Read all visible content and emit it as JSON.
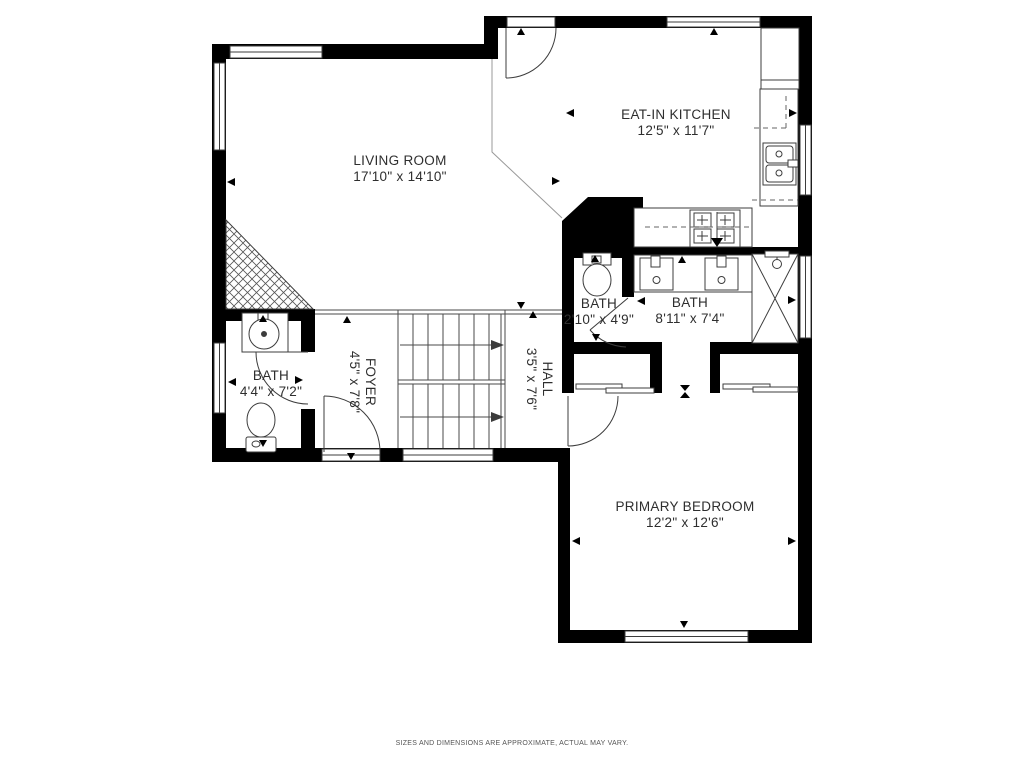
{
  "rooms": {
    "living_room": {
      "name": "LIVING ROOM",
      "dims": "17'10\" x 14'10\""
    },
    "kitchen": {
      "name": "EAT-IN KITCHEN",
      "dims": "12'5\" x 11'7\""
    },
    "wc_bath": {
      "name": "BATH",
      "dims": "2'10\" x 4'9\""
    },
    "primary_bath": {
      "name": "BATH",
      "dims": "8'11\" x 7'4\""
    },
    "hall_bath": {
      "name": "BATH",
      "dims": "4'4\" x 7'2\""
    },
    "foyer": {
      "name": "FOYER",
      "dims": "4'5\" x 7'8\""
    },
    "hall": {
      "name": "HALL",
      "dims": "3'5\" x 7'6\""
    },
    "primary_bedroom": {
      "name": "PRIMARY BEDROOM",
      "dims": "12'2\" x 12'6\""
    }
  },
  "footer": {
    "disclaimer": "SIZES AND DIMENSIONS ARE APPROXIMATE, ACTUAL MAY VARY."
  },
  "colors": {
    "wall": "#000000",
    "line": "#3c3c3c",
    "background": "#ffffff",
    "text": "#2e2e2e",
    "disclaimer_text": "#555555"
  }
}
